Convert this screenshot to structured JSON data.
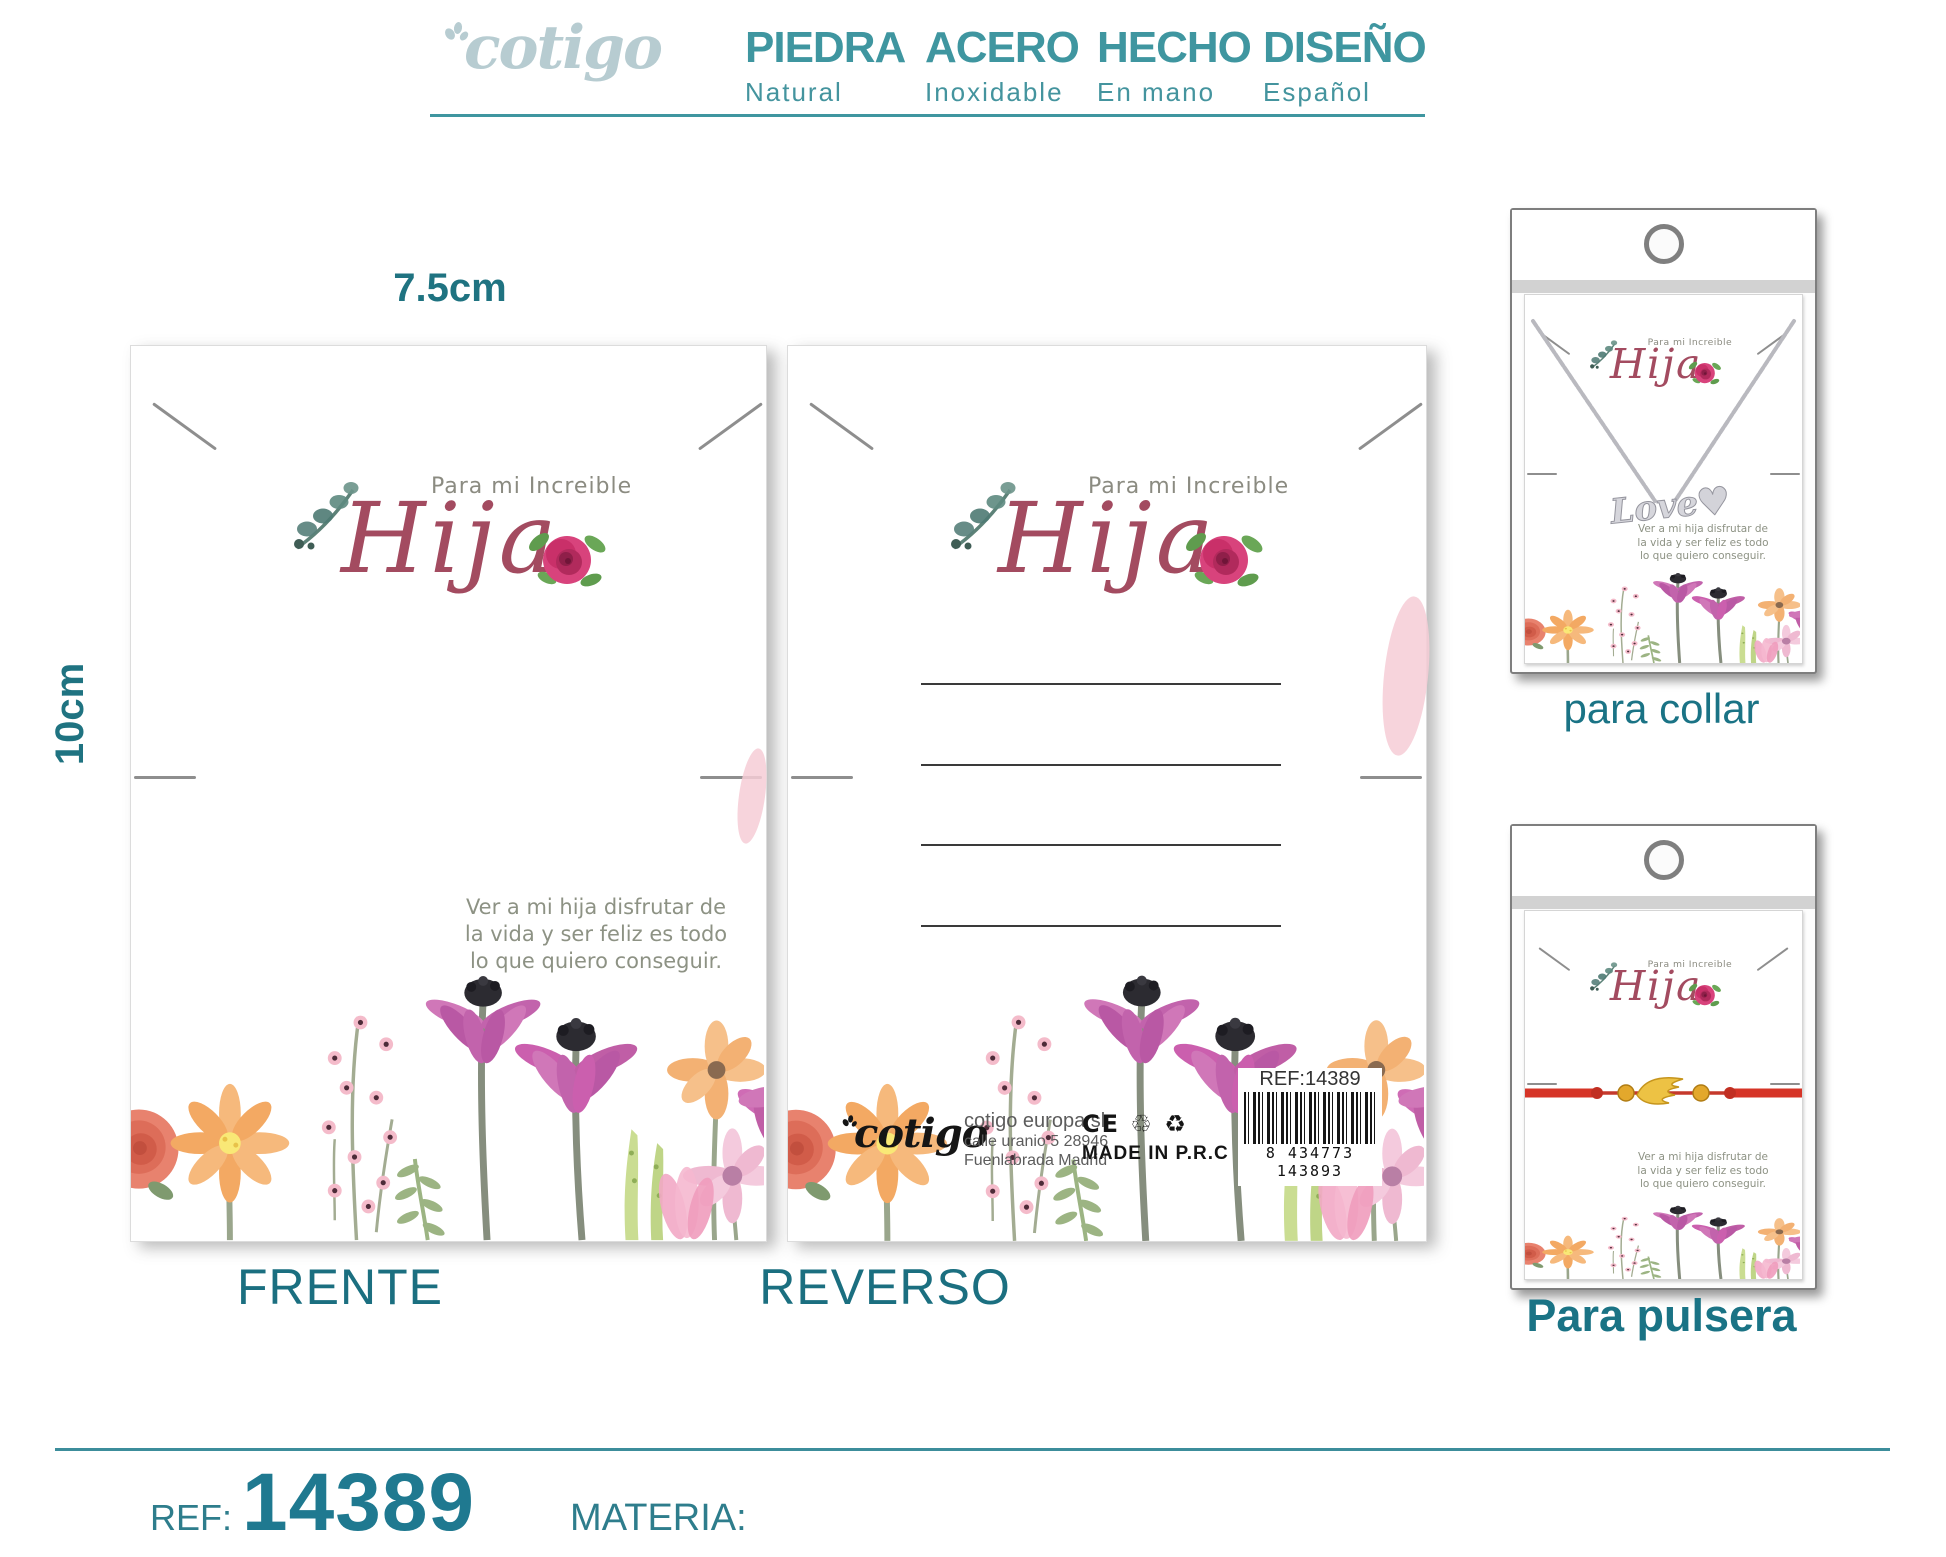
{
  "header": {
    "brand": "cotigo",
    "features": [
      {
        "title": "PIEDRA",
        "subtitle": "Natural"
      },
      {
        "title": "ACERO",
        "subtitle": "Inoxidable"
      },
      {
        "title": "HECHO",
        "subtitle": "En mano"
      },
      {
        "title": "DISEÑO",
        "subtitle": "Español"
      }
    ]
  },
  "dimensions": {
    "width": "7.5cm",
    "height": "10cm"
  },
  "card": {
    "tagline": "Para mi Increible",
    "name": "Hija",
    "quote": {
      "line1": "Ver a mi hija disfrutar de",
      "line2": "la vida y ser feliz es todo",
      "line3": "lo que quiero conseguir."
    }
  },
  "labels": {
    "front": "FRENTE",
    "back": "REVERSO",
    "collar": "para collar",
    "pulsera": "Para pulsera"
  },
  "back_card": {
    "brand": "cotigo",
    "address": {
      "line1": "cotigo europa sl",
      "line2": "calle uranio 5 28946",
      "line3": "Fuenlabrada Madrid"
    },
    "ce_mark": "CE ♲ ♻",
    "made_in": "MADE IN P.R.C",
    "barcode": {
      "ref": "REF:14389",
      "digits": "8 434773 143893"
    }
  },
  "products": {
    "collar": {
      "pendant_text": "Love"
    }
  },
  "footer": {
    "ref_label": "REF:",
    "ref_value": "14389",
    "materia_label": "MATERIA:"
  },
  "colors": {
    "teal_accent": "#3f96a0",
    "teal_dark": "#1f7381",
    "brand_gray_blue": "#b7ccd1",
    "script_rose": "#a34b60",
    "quote_gray": "#8d9284",
    "cord_red": "#d63427",
    "charm_gold": "#e3a82c",
    "chain_silver": "#c6c6cc"
  }
}
